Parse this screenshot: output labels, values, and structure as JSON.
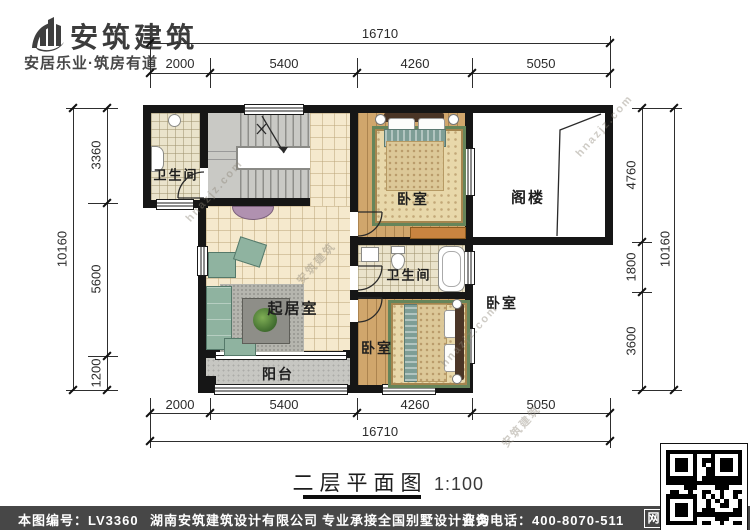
{
  "header": {
    "brand": "安筑建筑",
    "slogan": "安居乐业·筑房有道"
  },
  "dimensions": {
    "top": {
      "total": "16710",
      "segments": [
        "2000",
        "5400",
        "4260",
        "5050"
      ]
    },
    "bottom": {
      "total": "16710",
      "segments": [
        "2000",
        "5400",
        "4260",
        "5050"
      ]
    },
    "left": {
      "total": "10160",
      "segments": [
        "3360",
        "5600",
        "1200"
      ]
    },
    "right": {
      "total": "10160",
      "segments": [
        "4760",
        "1800",
        "3600"
      ]
    }
  },
  "rooms": {
    "bath_top": "卫生间",
    "bedroom_top": "卧室",
    "attic": "阁楼",
    "living": "起居室",
    "bath_mid": "卫生间",
    "bedroom_right": "卧室",
    "bedroom_bottom": "卧室",
    "balcony": "阳台"
  },
  "title": {
    "name": "二层平面图",
    "scale": "1:100"
  },
  "footer": {
    "drawing_no": "本图编号：LV3360",
    "company": "湖南安筑建筑设计有限公司",
    "service": "专业承接全国别墅设计业务",
    "phone": "咨询电话：400-8070-511",
    "web_badge": "网"
  },
  "watermarks": {
    "site": "hnazjz.com",
    "brand": "安筑建筑"
  },
  "colors": {
    "wall": "#161616",
    "tile_floor": "#f5e9cd",
    "wood_floor": "#d0a66c",
    "bath_floor": "#eae3cb",
    "stair_floor": "#c9c9c5",
    "balcony_floor": "#c7c7c2",
    "rug_border": "#66855a",
    "footer_bar": "#474747"
  }
}
